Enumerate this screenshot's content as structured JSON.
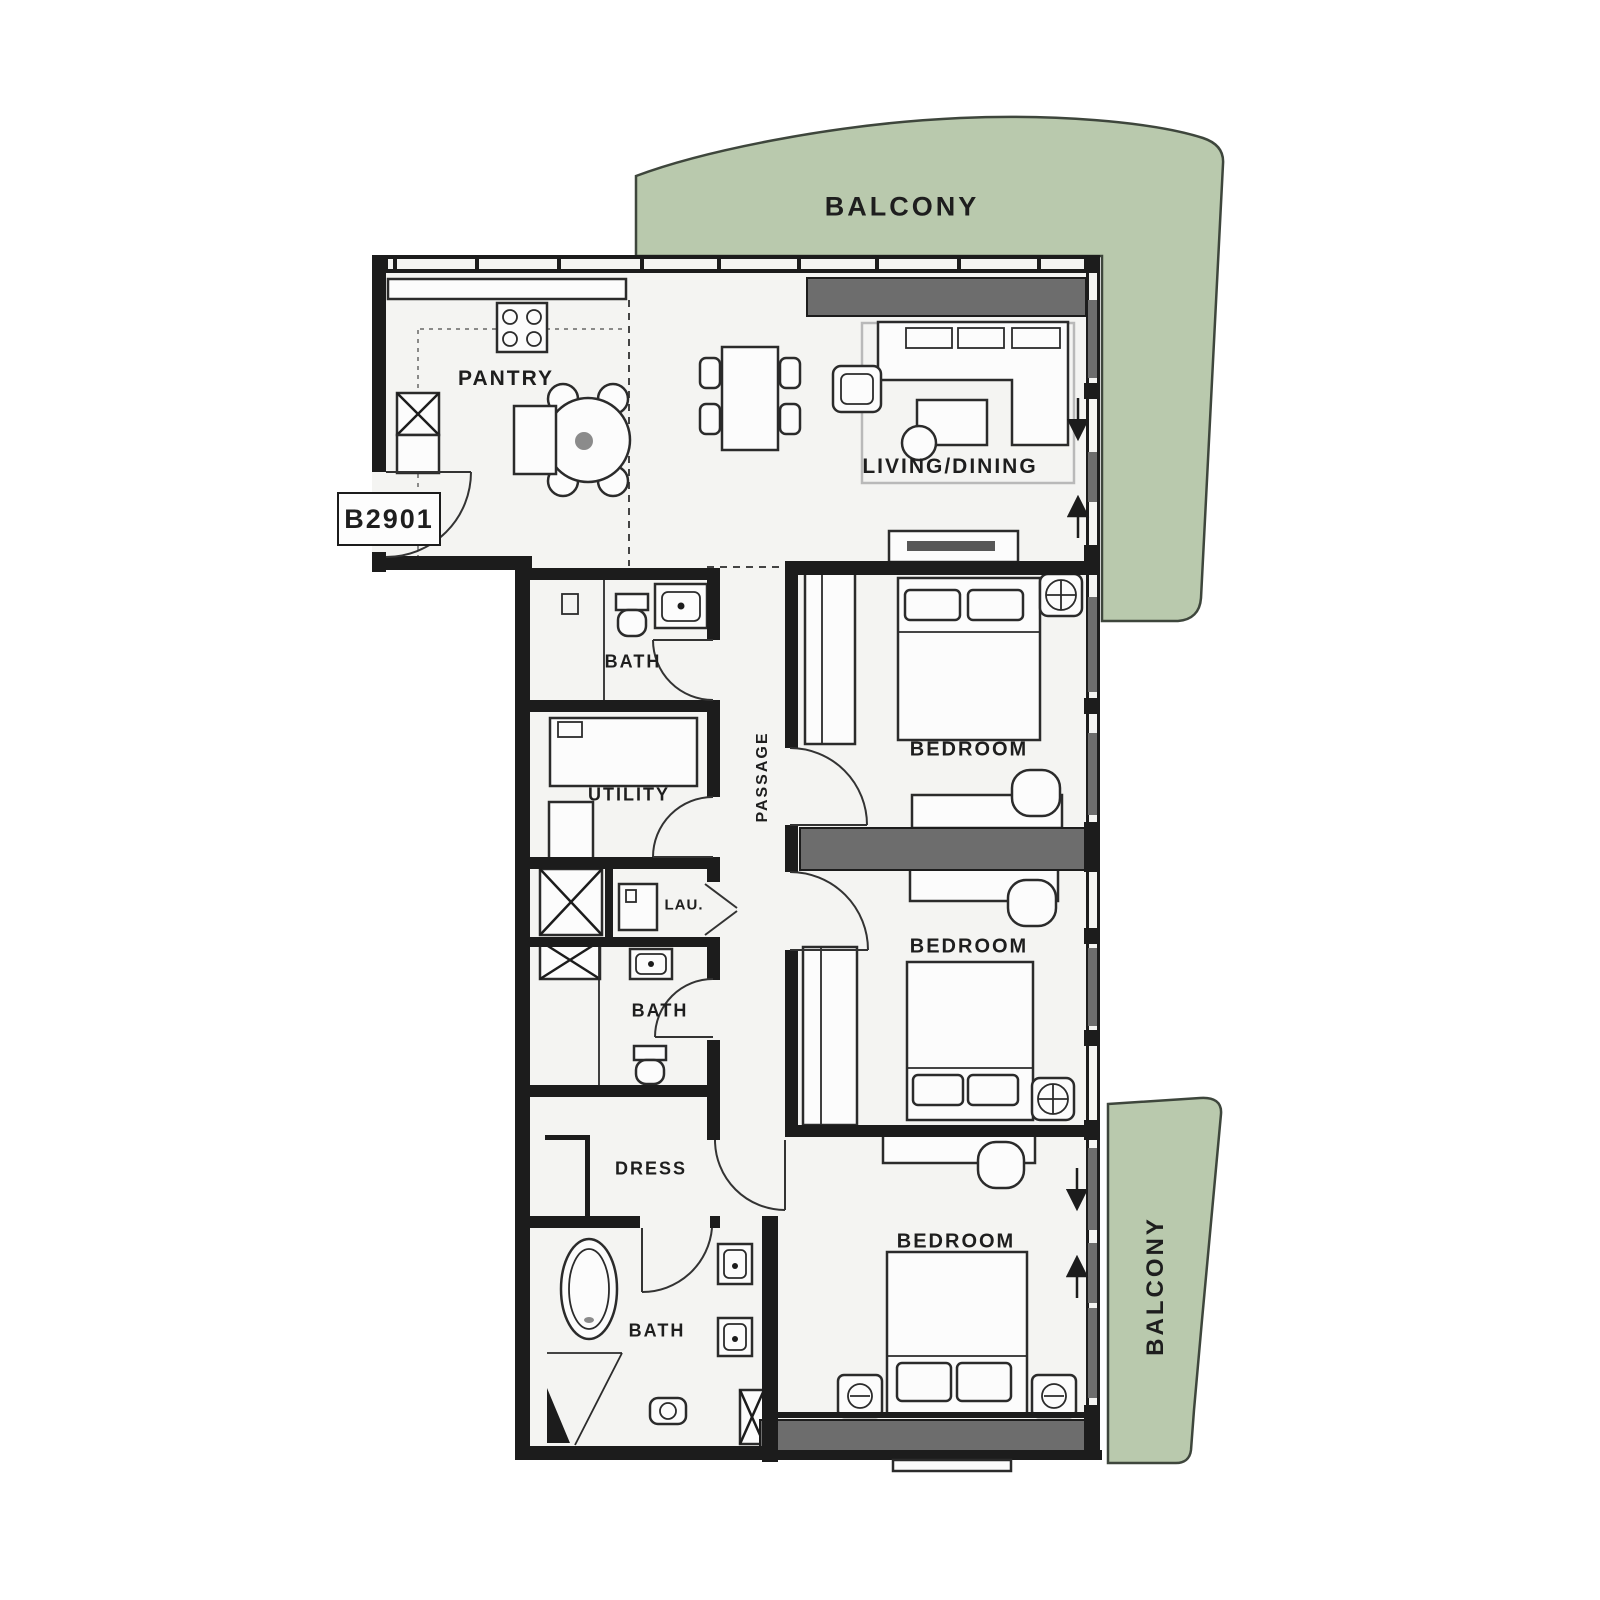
{
  "unit": {
    "number": "B2901"
  },
  "labels": {
    "balcony_top": "BALCONY",
    "balcony_right": "BALCONY",
    "pantry": "PANTRY",
    "living_dining": "LIVING/DINING",
    "bath_top": "BATH",
    "utility": "UTILITY",
    "passage": "PASSAGE",
    "laundry": "LAU.",
    "bath_mid": "BATH",
    "bedroom_1": "BEDROOM",
    "bedroom_2": "BEDROOM",
    "dress": "DRESS",
    "bath_master": "BATH",
    "bedroom_3": "BEDROOM"
  },
  "colors": {
    "balcony": "#b9c9ad",
    "balcony_outline": "#3e463c",
    "wall": "#1c1c1c",
    "floor": "#f4f4f2",
    "wardrobe_gray": "#6d6d6d",
    "tv_gray": "#575757"
  }
}
